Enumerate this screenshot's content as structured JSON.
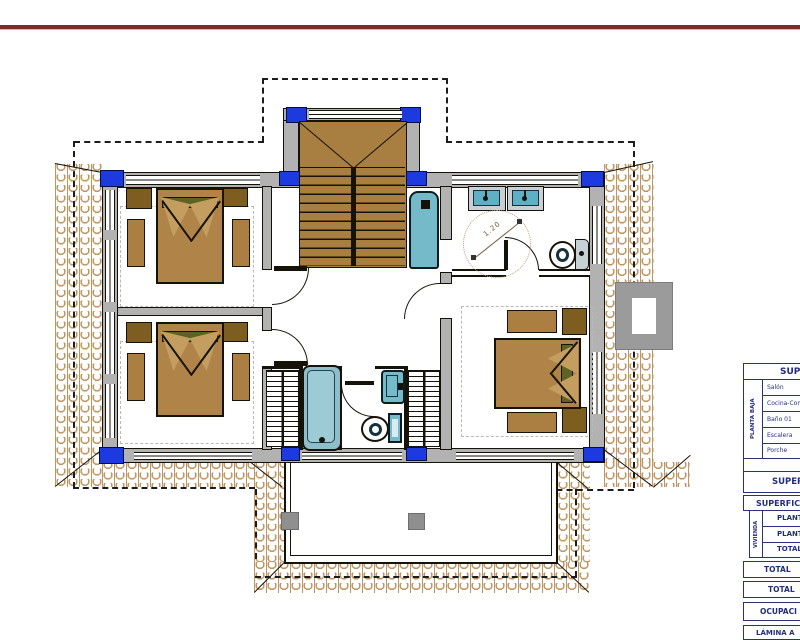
{
  "annotations": {
    "turning_circle_diameter": "1.20"
  },
  "tables": {
    "upper": {
      "header": "SUPE",
      "group_label": "PLANTA BAJA",
      "rows": [
        "Salón",
        "Cocina-Comedor",
        "Baño 01",
        "Escalera",
        "Porche"
      ],
      "total_label": "SUPERFI"
    },
    "lower": {
      "header": "SUPERFIC",
      "group_label": "VIVIENDA",
      "rows": [
        "PLANTA",
        "PLANTA",
        "TOTAL"
      ],
      "summary_rows": [
        "TOTAL",
        "TOTAL",
        "OCUPACI",
        "LÁMINA A"
      ]
    }
  },
  "colors": {
    "rule_maroon": "#7b2d21",
    "column_blue": "#1d39e0",
    "wall_gray": "#b2b2b2",
    "wood_tan": "#ab7f42",
    "wood_dark": "#7e5d20",
    "fixture_cyan": "#74bac9",
    "roof_tile_tan": "#bf9560",
    "table_navy": "#232e7a"
  }
}
